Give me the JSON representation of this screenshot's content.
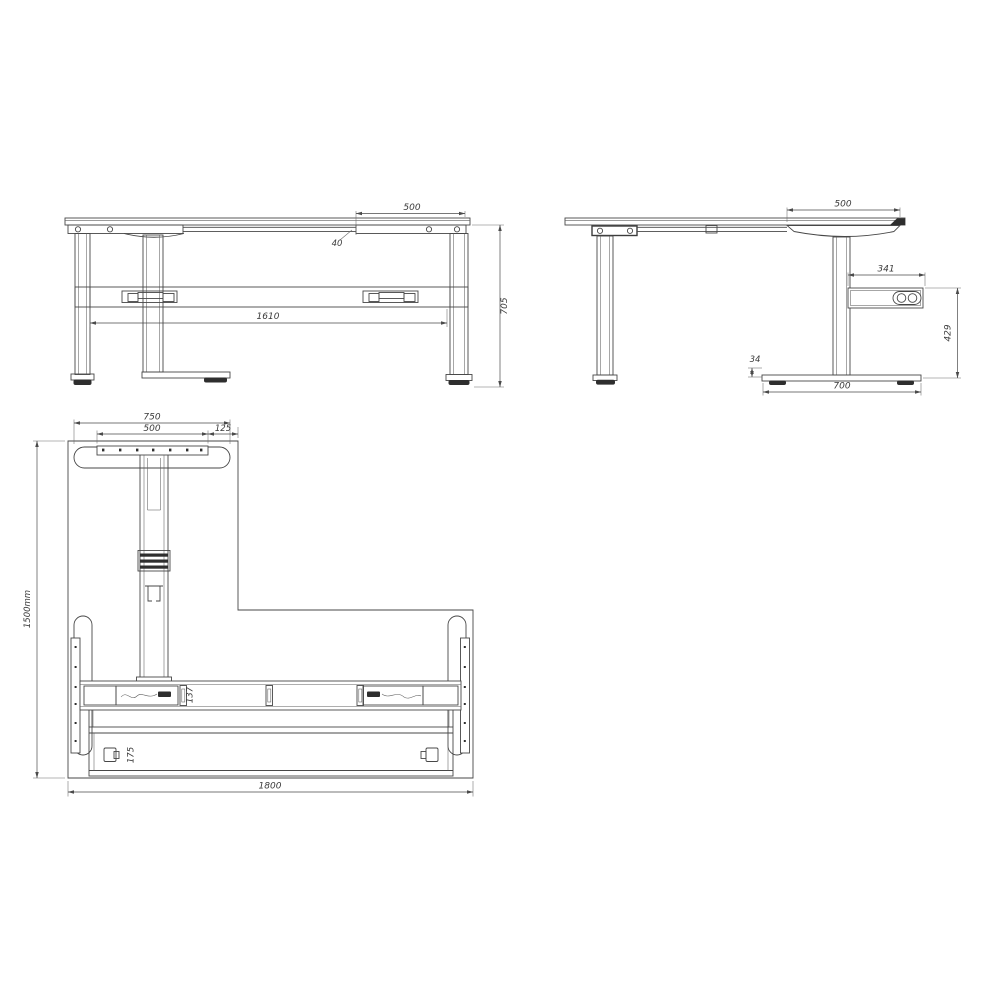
{
  "drawing": {
    "title": "height-adjustable L-desk frame technical drawing",
    "front_view": {
      "dim_overhang": "500",
      "dim_gap": "40",
      "dim_beam_length": "1610",
      "dim_height": "705"
    },
    "side_view": {
      "dim_overhang": "500",
      "dim_control_box_width": "341",
      "dim_box_to_floor": "429",
      "dim_foot_height": "34",
      "dim_foot_depth": "700"
    },
    "plan_view": {
      "dim_foot_width": "750",
      "dim_plate_width": "500",
      "dim_edge_offset": "125",
      "dim_depth": "1500mm",
      "dim_crossbeam_width": "137",
      "dim_lower_beam_width": "175",
      "dim_total_width": "1800"
    }
  }
}
